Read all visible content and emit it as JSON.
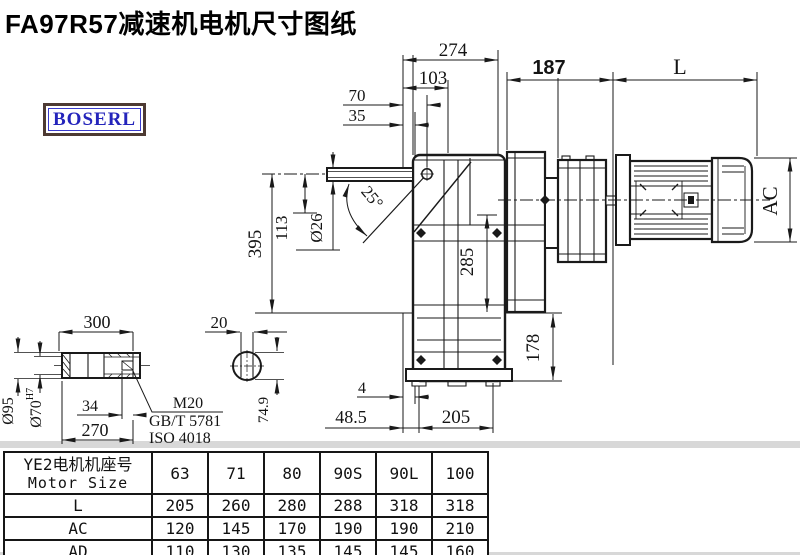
{
  "title": "FA97R57减速机电机尺寸图纸",
  "logo": {
    "text": "BOSERL"
  },
  "colors": {
    "line": "#1a1a1a",
    "logo_border": "#4d3a33",
    "logo_text": "#2424bb",
    "separator": "#d8d8d8"
  },
  "dims": {
    "d274": "274",
    "d103": "103",
    "d70": "70",
    "d35": "35",
    "d395": "395",
    "d113": "113",
    "dia26": "Ø26",
    "ang25": "25°",
    "d285": "285",
    "d178": "178",
    "d4": "4",
    "d48_5": "48.5",
    "d205": "205",
    "d187": "187",
    "L": "L",
    "AC": "AC",
    "d300": "300",
    "d20": "20",
    "dia95": "Ø95",
    "dia70": "Ø70",
    "h7": "H7",
    "d34": "34",
    "d270": "270",
    "d74_9": "74.9",
    "m20": "M20",
    "gbt": "GB/T 5781",
    "iso": "ISO 4018"
  },
  "table": {
    "header": {
      "line1": "YE2电机机座号",
      "line2": "Motor Size"
    },
    "sizes": [
      "63",
      "71",
      "80",
      "90S",
      "90L",
      "100"
    ],
    "rows": [
      {
        "label": "L",
        "values": [
          "205",
          "260",
          "280",
          "288",
          "318",
          "318"
        ]
      },
      {
        "label": "AC",
        "values": [
          "120",
          "145",
          "170",
          "190",
          "190",
          "210"
        ]
      },
      {
        "label": "AD",
        "values": [
          "110",
          "130",
          "135",
          "145",
          "145",
          "160"
        ]
      }
    ]
  }
}
